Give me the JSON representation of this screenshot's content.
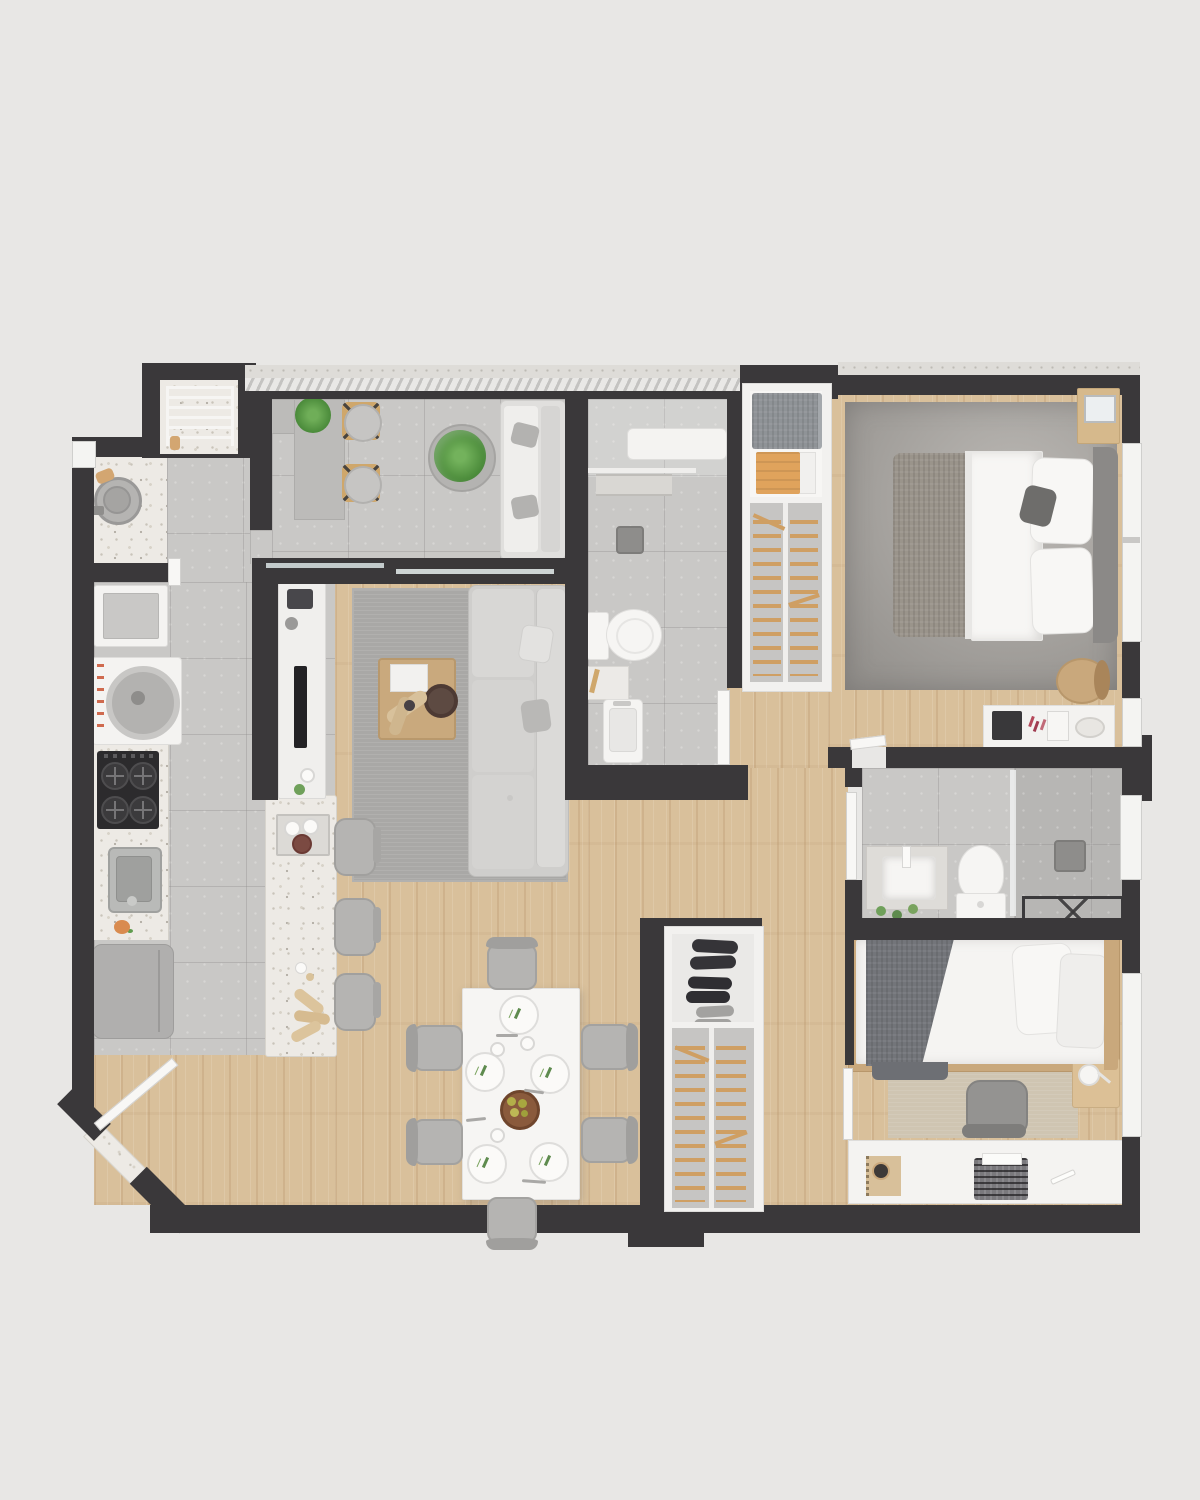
{
  "meta": {
    "content_type": "3d-rendered apartment floor plan, top-down view",
    "canvas_px": {
      "width": 1200,
      "height": 1500
    },
    "visible_text_labels": []
  },
  "palette": {
    "page_background": "#e8e7e5",
    "walls": "#3a383a",
    "wood_floor": "#d9c09b",
    "concrete_tile_floor": "#c9c8c6",
    "terrazzo_surface": "#edeae5",
    "white_furniture": "#f6f5f3",
    "fabric_gray": "#c9c8c6",
    "hanger_rail_wood": "#cf9f63",
    "towel_orange": "#e0a35c",
    "plant_green": "#5f9c4e",
    "blanket_dark_gray": "#73757a"
  },
  "apartment": {
    "rooms": [
      {
        "id": "balcony",
        "label": "balcony-terrace",
        "floor": "concrete-tile",
        "furniture": [
          "glazed-railing",
          "l-shaped-console-desk",
          "potted-plant",
          "wooden-stool",
          "wooden-stool",
          "round-planter-with-fern",
          "outdoor-sofa-with-2-cushions",
          "sliding-glass-door"
        ]
      },
      {
        "id": "service-area",
        "label": "laundry-service-area",
        "floor": "terrazzo-and-tile",
        "furniture": [
          "drying-rack-niche",
          "round-laundry-tub",
          "utility-sink",
          "washing-machine"
        ]
      },
      {
        "id": "kitchen",
        "label": "kitchen",
        "floor": "concrete-tile",
        "furniture": [
          "cooktop-4-burners",
          "stainless-sink",
          "refrigerator",
          "terrazzo-counter",
          "terrazzo-island",
          "bar-stool",
          "bar-stool",
          "bar-stool",
          "serving-tray-with-cups",
          "pampas-vase",
          "tv-console",
          "tv-panel",
          "speaker"
        ]
      },
      {
        "id": "living-room",
        "label": "living-room",
        "floor": "wood",
        "furniture": [
          "gray-area-rug",
          "sofa-with-chaise",
          "throw-pillow",
          "throw-pillow",
          "floor-lamp",
          "wood-coffee-table",
          "book-stack",
          "decor-bowl",
          "dried-grass"
        ]
      },
      {
        "id": "bathroom-1",
        "label": "social-bathroom",
        "floor": "concrete-tile",
        "furniture": [
          "shower-bench",
          "shower-mixer",
          "terrazzo-step",
          "toilet",
          "shelf-caddy",
          "washbasin",
          "door-leaf"
        ]
      },
      {
        "id": "wardrobe-1",
        "label": "bedroom-1-closet",
        "floor": "closet-base",
        "furniture": [
          "folded-gray-blanket",
          "orange-towel-stack",
          "hanging-rails",
          "center-divider"
        ]
      },
      {
        "id": "bedroom-1",
        "label": "master-bedroom",
        "floor": "wood",
        "furniture": [
          "large-gray-rug",
          "double-bed",
          "white-duvet",
          "knit-throw",
          "pillow",
          "pillow",
          "accent-pillow",
          "upholstered-headboard",
          "nightstand",
          "alarm-clock",
          "accent-chair",
          "vanity-dresser",
          "makeup-items",
          "window",
          "window"
        ]
      },
      {
        "id": "bathroom-2",
        "label": "ensuite-bathroom",
        "floor": "concrete-tile",
        "furniture": [
          "vanity-counter",
          "washbasin",
          "toilet",
          "walk-in-shower",
          "glass-screen",
          "shower-mixer",
          "towel-bench",
          "small-plants",
          "window",
          "door-leaf"
        ]
      },
      {
        "id": "wardrobe-2",
        "label": "hall-shoe-closet",
        "floor": "closet-base",
        "furniture": [
          "shoe-pair-dark",
          "shoe-pair-dark",
          "shoe-pair-light",
          "hanging-rails",
          "center-divider"
        ]
      },
      {
        "id": "bedroom-2",
        "label": "second-bedroom",
        "floor": "wood",
        "furniture": [
          "single-bed-wood-frame",
          "white-duvet",
          "dark-gray-blanket",
          "pillow",
          "pillow",
          "beige-rug",
          "side-table",
          "table-lamp",
          "desk",
          "desk-chair",
          "notebook",
          "typewriter",
          "pen",
          "window"
        ]
      },
      {
        "id": "dining-area",
        "label": "dining-area",
        "floor": "wood",
        "furniture": [
          "white-dining-table",
          "chair",
          "chair",
          "chair",
          "chair",
          "chair",
          "chair",
          "place-setting-plates-x5",
          "fruit-bowl-with-pears",
          "cutlery",
          "cups"
        ]
      },
      {
        "id": "entry",
        "label": "entrance",
        "floor": "wood",
        "furniture": [
          "chamfered-corner-wall",
          "terrazzo-threshold",
          "open-front-door-leaf"
        ]
      }
    ],
    "counts": {
      "bedrooms": 2,
      "bathrooms": 2,
      "closets": 2,
      "bar_stools": 3,
      "dining_chairs": 6,
      "plates": 5,
      "shoe_pairs": 3
    }
  }
}
